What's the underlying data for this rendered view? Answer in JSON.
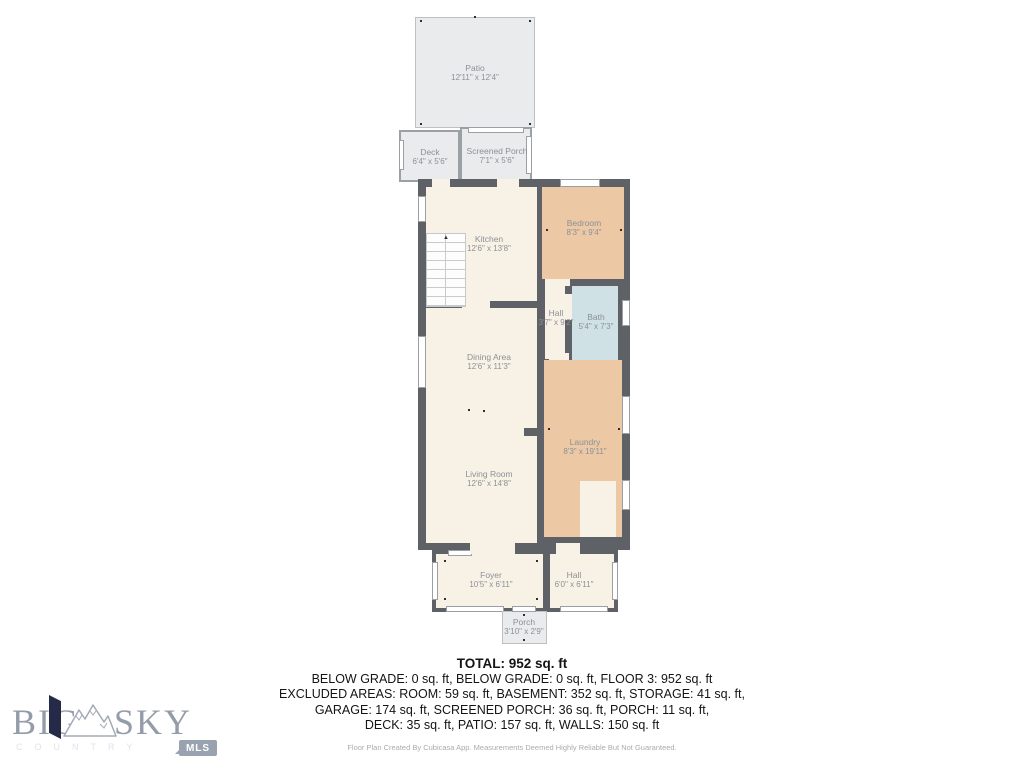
{
  "floorplan": {
    "rooms": {
      "patio": {
        "name": "Patio",
        "dims": "12'11\" x 12'4\""
      },
      "deck": {
        "name": "Deck",
        "dims": "6'4\" x 5'6\""
      },
      "screened_porch": {
        "name": "Screened Porch",
        "dims": "7'1\" x 5'6\""
      },
      "kitchen": {
        "name": "Kitchen",
        "dims": "12'6\" x 13'8\""
      },
      "bedroom": {
        "name": "Bedroom",
        "dims": "8'3\" x 9'4\""
      },
      "hall_upper": {
        "name": "Hall",
        "dims": "3'7\" x 9'2\""
      },
      "bath": {
        "name": "Bath",
        "dims": "5'4\" x 7'3\""
      },
      "dining": {
        "name": "Dining Area",
        "dims": "12'6\" x 11'3\""
      },
      "laundry": {
        "name": "Laundry",
        "dims": "8'3\" x 19'11\""
      },
      "living": {
        "name": "Living Room",
        "dims": "12'6\" x 14'8\""
      },
      "foyer": {
        "name": "Foyer",
        "dims": "10'5\" x 6'11\""
      },
      "hall_lower": {
        "name": "Hall",
        "dims": "6'0\" x 6'11\""
      },
      "porch": {
        "name": "Porch",
        "dims": "3'10\" x 2'9\""
      }
    },
    "colors": {
      "floor_interior": "#f8f1e6",
      "floor_bedroom_laundry": "#ecc8a5",
      "floor_bath": "#cfe1e4",
      "outdoor_area": "#eaebec",
      "wall": "#5e6266"
    }
  },
  "summary": {
    "total": "TOTAL: 952 sq. ft",
    "line1": "BELOW GRADE: 0 sq. ft, BELOW GRADE: 0 sq. ft, FLOOR 3: 952 sq. ft",
    "line2": "EXCLUDED AREAS: ROOM: 59 sq. ft, BASEMENT: 352 sq. ft, STORAGE: 41 sq. ft,",
    "line3": "GARAGE: 174 sq. ft, SCREENED PORCH: 36 sq. ft, PORCH: 11 sq. ft,",
    "line4": "DECK: 35 sq. ft, PATIO: 157 sq. ft, WALLS: 150 sq. ft",
    "disclaimer": "Floor Plan Created By Cubicasa App. Measurements Deemed Highly Reliable But Not Guaranteed."
  },
  "logo": {
    "word1": "BIG",
    "word2": "SKY",
    "subtitle": "COUNTRY",
    "badge": "MLS"
  }
}
